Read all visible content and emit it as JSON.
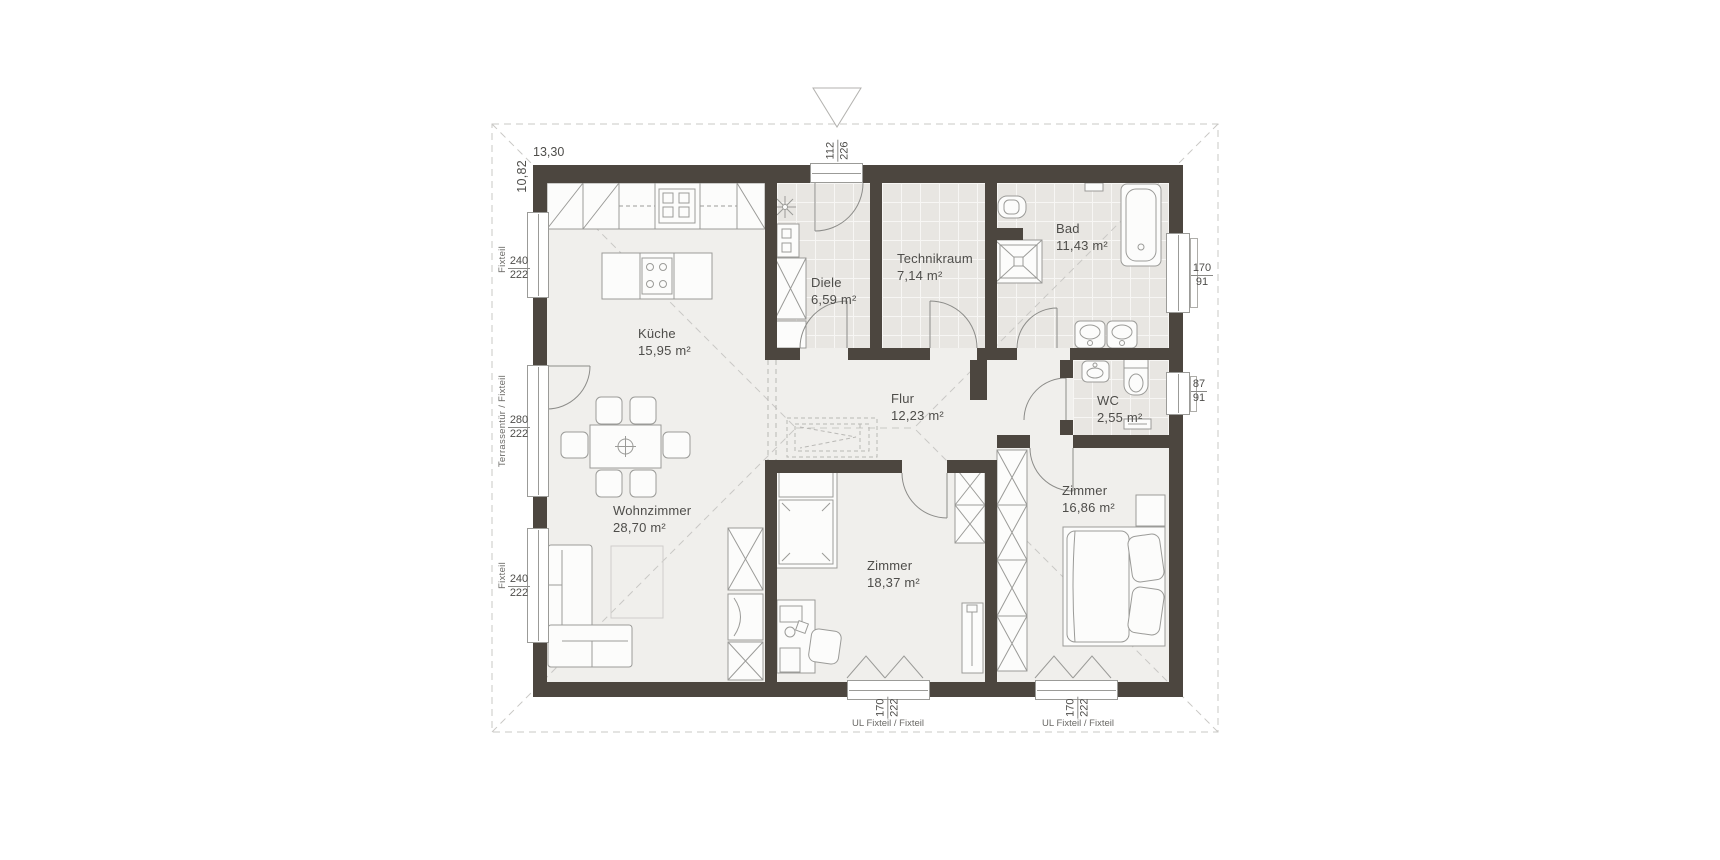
{
  "rooms": [
    {
      "name": "Küche",
      "area": "15,95 m²"
    },
    {
      "name": "Wohnzimmer",
      "area": "28,70 m²"
    },
    {
      "name": "Diele",
      "area": "6,59 m²"
    },
    {
      "name": "Technikraum",
      "area": "7,14 m²"
    },
    {
      "name": "Bad",
      "area": "11,43 m²"
    },
    {
      "name": "Flur",
      "area": "12,23 m²"
    },
    {
      "name": "WC",
      "area": "2,55 m²"
    },
    {
      "name": "Zimmer",
      "area": "18,37 m²"
    },
    {
      "name": "Zimmer",
      "area": "16,86 m²"
    }
  ],
  "dims": {
    "total_width": "13,30",
    "total_depth": "10,82",
    "entry_door": {
      "top": "112",
      "bottom": "226"
    },
    "left": [
      {
        "type": "Fixteil",
        "top": "240",
        "bottom": "222"
      },
      {
        "type": "Terrassentür / Fixteil",
        "top": "280",
        "bottom": "222"
      },
      {
        "type": "Fixteil",
        "top": "240",
        "bottom": "222"
      }
    ],
    "right": [
      {
        "top": "170",
        "bottom": "91"
      },
      {
        "top": "87",
        "bottom": "91"
      }
    ],
    "bottom": [
      {
        "type": "UL Fixteil / Fixteil",
        "top": "170",
        "bottom": "222"
      },
      {
        "type": "UL Fixteil / Fixteil",
        "top": "170",
        "bottom": "222"
      }
    ]
  },
  "colors": {
    "wall": "#4c463f",
    "tile_floor": "#e8e6e2",
    "floor": "#f0efec",
    "dash": "#c9c8c5",
    "line": "#9b9b98",
    "text": "#4e4d4a"
  }
}
